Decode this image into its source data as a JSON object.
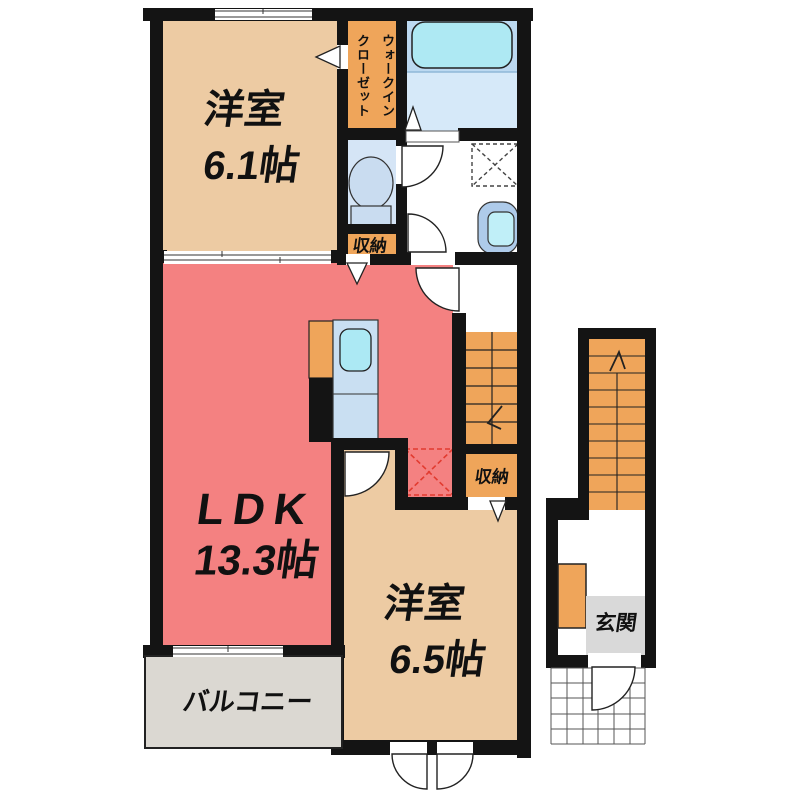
{
  "rooms": {
    "bedroom1": {
      "name": "洋室",
      "size": "6.1帖"
    },
    "walk_in_closet": {
      "line1": "ウォークイン",
      "line2": "クローゼット"
    },
    "hall_storage": {
      "label": "収納"
    },
    "ldk": {
      "name": "LDK",
      "size": "13.3帖"
    },
    "bedroom2": {
      "name": "洋室",
      "size": "6.5帖"
    },
    "stair_storage": {
      "label": "収納"
    },
    "balcony": {
      "label": "バルコニー"
    },
    "entrance": {
      "label": "玄関"
    }
  },
  "fixtures": [
    "bathtub",
    "toilet",
    "washbasin",
    "washing-machine-place",
    "kitchen-counter-sink",
    "refrigerator-place",
    "staircase-down",
    "staircase-up",
    "swing-doors",
    "entrance-porch-tiles"
  ],
  "colors": {
    "wall": "#141414",
    "bedroom_beige": "#EDCBA3",
    "closet_orange": "#EFA55A",
    "ldk_salmon": "#F48181",
    "bath_blue": "#BCD9F1",
    "bath_floor_blue": "#D6E9F9",
    "bathtub_cyan": "#AEE9F3",
    "toilet_room_blue": "#D5E5F6",
    "kitchen_counter_blue": "#C9DFF2",
    "sink_cyan": "#ACE9F4",
    "balcony_gray": "#DBD8D2",
    "entrance_gray": "#D9D9D9",
    "refrigerator_dashed_red": "#E23B30"
  }
}
